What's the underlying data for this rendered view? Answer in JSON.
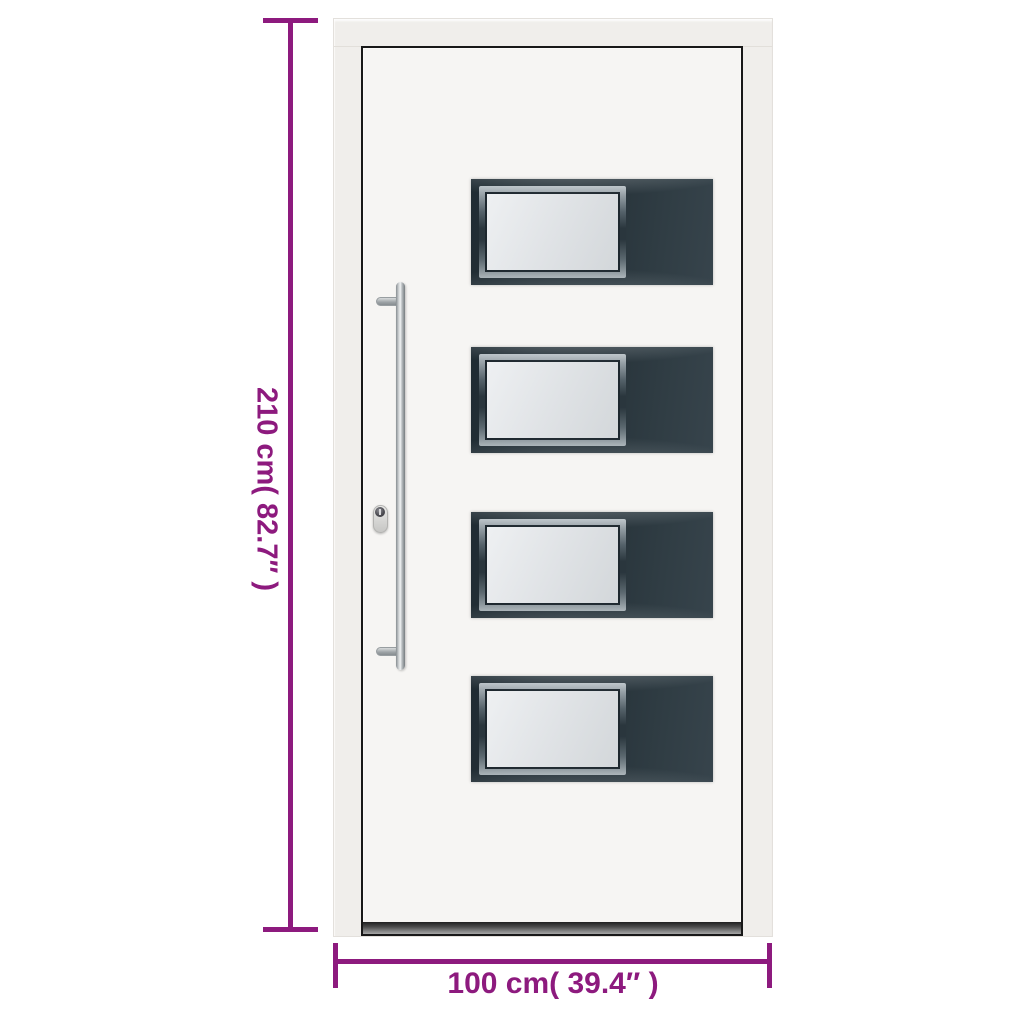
{
  "diagram": {
    "height_dimension": {
      "label": "210 cm( 82.7″ )"
    },
    "width_dimension": {
      "label": "100 cm( 39.4″ )"
    }
  },
  "door": {
    "panel_count": 4
  },
  "theme": {
    "accent": "#8d1a7e",
    "canvas": "#ffffff",
    "frame": "#f0eeeb",
    "leaf": "#f6f5f3",
    "leaf-outline": "#181818",
    "panel": "#28343b",
    "glass": "#e0e3e6",
    "metal": "#cdd1d3"
  }
}
